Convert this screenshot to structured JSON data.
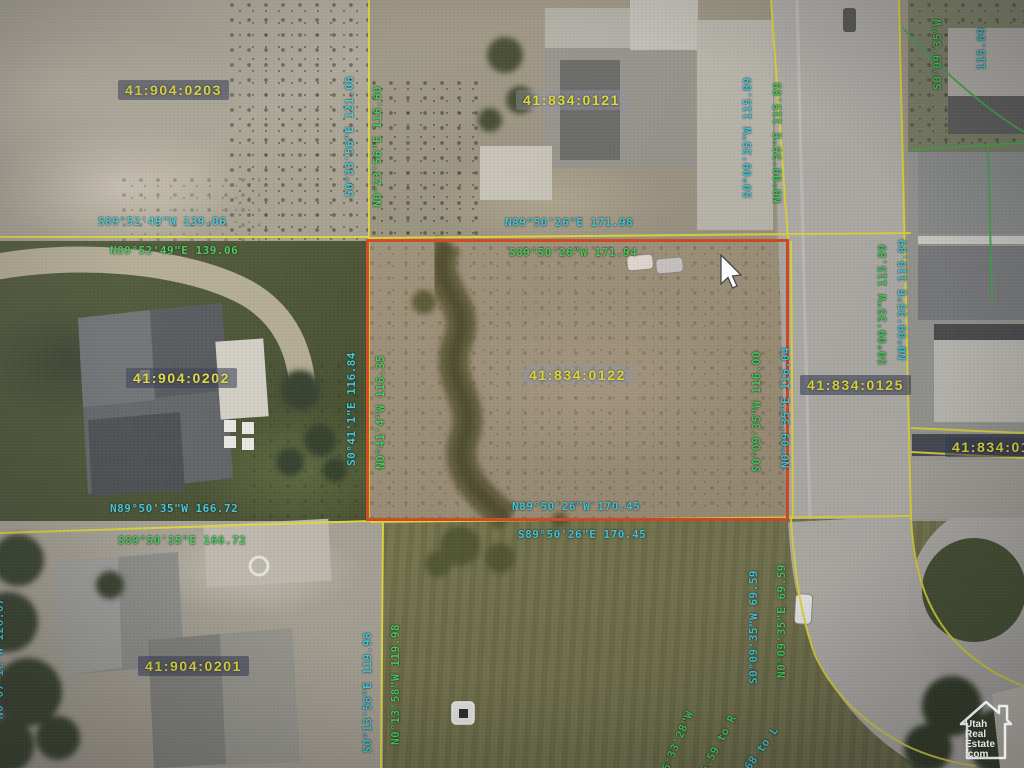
{
  "map": {
    "selected_parcel_id": "41:834:0122",
    "parcel_ids": {
      "p0203": "41:904:0203",
      "p0121": "41:834:0121",
      "p0202": "41:904:0202",
      "p0122": "41:834:0122",
      "p0125": "41:834:0125",
      "p012x": "41:834:012",
      "p0201": "41:904:0201"
    },
    "bearings": [
      {
        "text": "S0°33'56\"E 121.06",
        "color": "teal"
      },
      {
        "text": "N0°23'56\"E 116.60",
        "color": "green"
      },
      {
        "text": "S89°52'49\"W 139.06",
        "color": "teal"
      },
      {
        "text": "N89°52'49\"E 139.06",
        "color": "green"
      },
      {
        "text": "N89°50'26\"E 171.98",
        "color": "teal"
      },
      {
        "text": "S89°50'26\"W 171.94",
        "color": "green"
      },
      {
        "text": "S0°41'1\"E 116.84",
        "color": "teal"
      },
      {
        "text": "N0°41'4\"W 116.35",
        "color": "green"
      },
      {
        "text": "S0°09'35\"W 116.00",
        "color": "green"
      },
      {
        "text": "N0°09'35\"E 116.04",
        "color": "teal"
      },
      {
        "text": "S0°09'35\"W 115.89",
        "color": "teal"
      },
      {
        "text": "N0°09'35\"E 115.89",
        "color": "green"
      },
      {
        "text": "S0°09'35\"W 115.89",
        "color": "green"
      },
      {
        "text": "N0°09'35\"E 115.89",
        "color": "teal"
      },
      {
        "text": "S0°13'58\"E 119.98",
        "color": "teal"
      },
      {
        "text": "N0°13'58\"W 119.98",
        "color": "green"
      },
      {
        "text": "S0°09'35\"W 69.59",
        "color": "teal"
      },
      {
        "text": "N0°09'35\"E 69.59",
        "color": "green"
      },
      {
        "text": "N0°07'16\"W 126.67",
        "color": "teal"
      },
      {
        "text": "S16°33'28\"W",
        "color": "green"
      },
      {
        "text": "56.59 to R",
        "color": "green"
      },
      {
        "text": "36.68 to L",
        "color": "teal"
      },
      {
        "text": "S0°09'35\"W",
        "color": "green"
      },
      {
        "text": "115.89",
        "color": "teal"
      },
      {
        "text": "N89°50'26\"W 170.45",
        "color": "teal"
      },
      {
        "text": "S89°50'26\"E 170.45",
        "color": "teal"
      },
      {
        "text": "N89°50'35\"W 166.72",
        "color": "teal"
      },
      {
        "text": "S89°50'35\"E 166.72",
        "color": "green"
      }
    ],
    "colors": {
      "parcel_id_text": "#e6e02f",
      "bearing_teal": "#38d2e2",
      "bearing_green": "#3ed455",
      "parcel_line_yellow": "#e6de2e",
      "selected_parcel_red": "#e0481c",
      "boundary_green": "#3fae4a"
    }
  },
  "watermark": {
    "l1": "Utah",
    "l2": "Real",
    "l3": "Estate",
    "l4": ".com"
  }
}
